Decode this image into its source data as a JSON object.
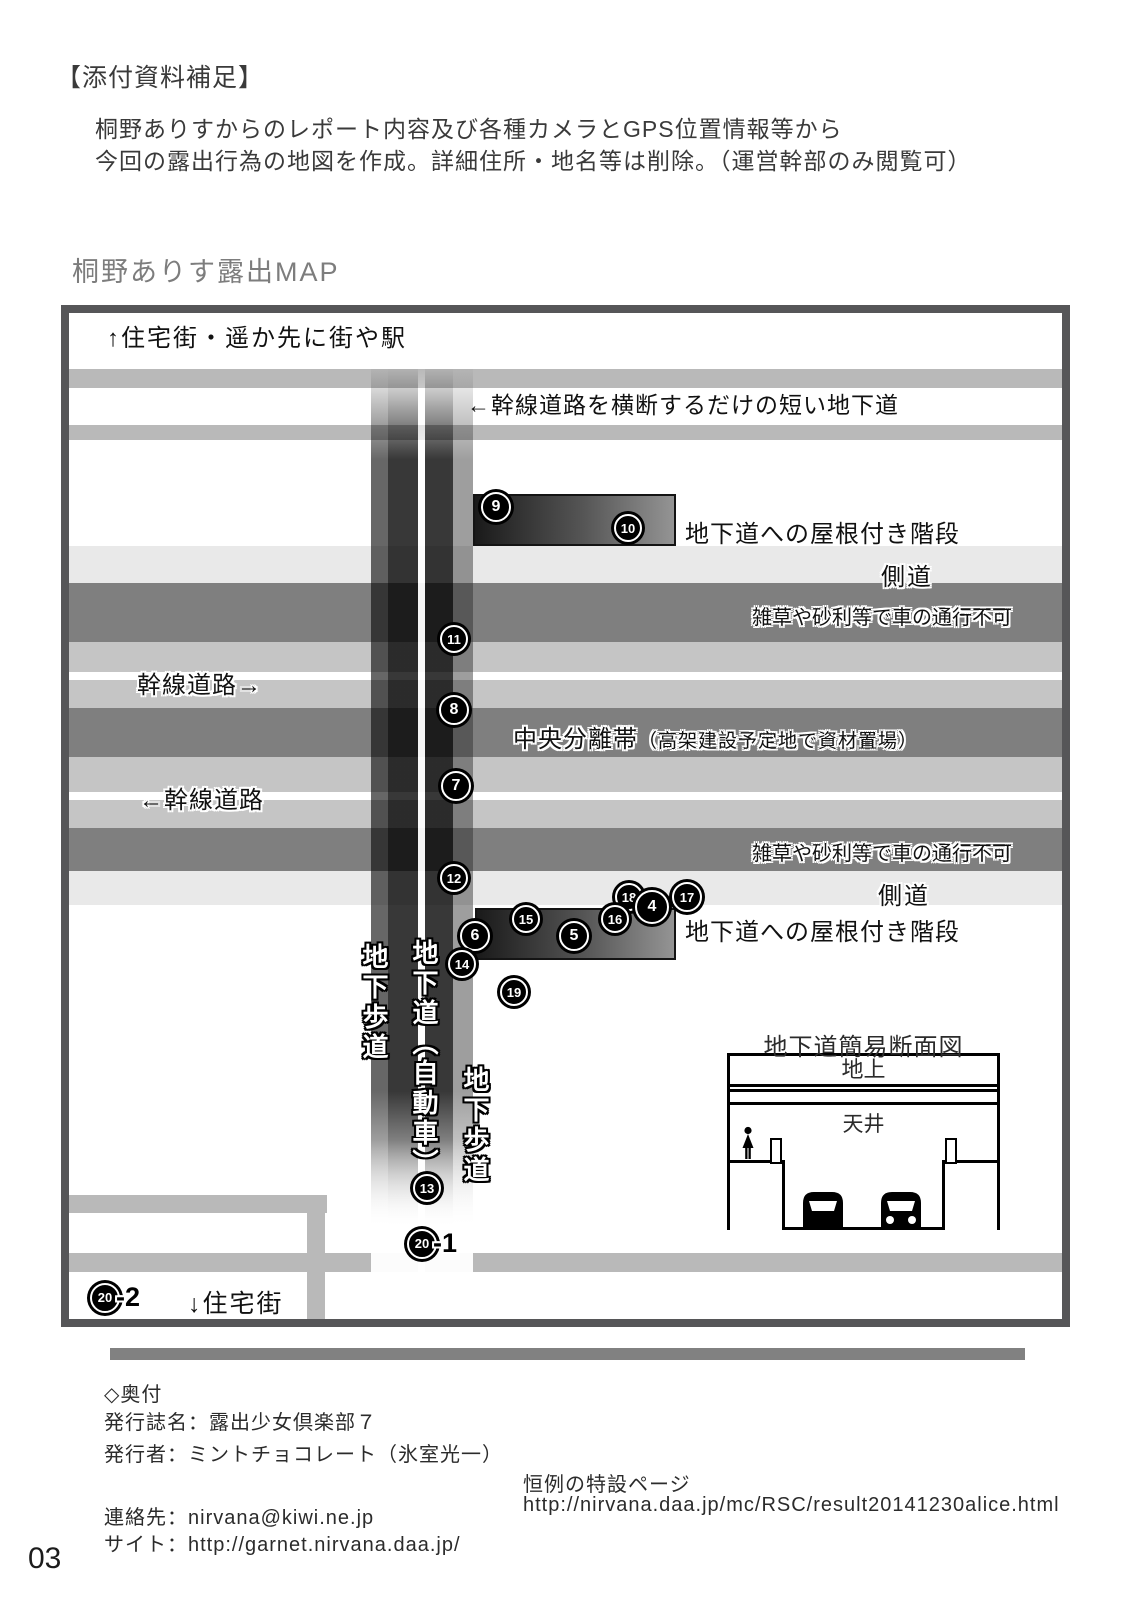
{
  "header": {
    "tag": "【添付資料補足】",
    "line1": "桐野ありすからのレポート内容及び各種カメラとGPS位置情報等から",
    "line2": "今回の露出行為の地図を作成。詳細住所・地名等は削除。（運営幹部のみ閲覧可）",
    "map_title": "桐野ありす露出MAP"
  },
  "map": {
    "labels": {
      "north": "↑住宅街・遥か先に街や駅",
      "short_underpass": "←幹線道路を横断するだけの短い地下道",
      "roofed_stairs_top": "地下道への屋根付き階段",
      "roofed_stairs_bottom": "地下道への屋根付き階段",
      "side_road_top": "側道",
      "side_road_bottom": "側道",
      "weeds_top": "雑草や砂利等で車の通行不可",
      "weeds_bottom": "雑草や砂利等で車の通行不可",
      "main_road_eastbound": "幹線道路→",
      "main_road_westbound": "←幹線道路",
      "median": "中央分離帯",
      "median_note": "（高架建設予定地で資材置場）",
      "ped_underpass_left": "地下歩道",
      "auto_underpass": "地下道（自動車）",
      "ped_underpass_right": "地下歩道",
      "south": "↓住宅街"
    },
    "pins": [
      {
        "label": "9",
        "x": 427,
        "y": 194,
        "size": 30
      },
      {
        "label": "10",
        "x": 559,
        "y": 215,
        "size": 28
      },
      {
        "label": "11",
        "x": 385,
        "y": 326,
        "size": 28
      },
      {
        "label": "8",
        "x": 385,
        "y": 397,
        "size": 30
      },
      {
        "label": "7",
        "x": 387,
        "y": 473,
        "size": 30
      },
      {
        "label": "12",
        "x": 385,
        "y": 565,
        "size": 28
      },
      {
        "label": "18",
        "x": 560,
        "y": 584,
        "size": 28
      },
      {
        "label": "4",
        "x": 583,
        "y": 594,
        "size": 34
      },
      {
        "label": "17",
        "x": 618,
        "y": 584,
        "size": 30
      },
      {
        "label": "15",
        "x": 457,
        "y": 606,
        "size": 28
      },
      {
        "label": "16",
        "x": 546,
        "y": 606,
        "size": 28
      },
      {
        "label": "6",
        "x": 406,
        "y": 623,
        "size": 30
      },
      {
        "label": "5",
        "x": 505,
        "y": 623,
        "size": 30
      },
      {
        "label": "14",
        "x": 393,
        "y": 651,
        "size": 28
      },
      {
        "label": "19",
        "x": 445,
        "y": 679,
        "size": 28
      },
      {
        "label": "13",
        "x": 358,
        "y": 875,
        "size": 28
      },
      {
        "label": "20",
        "suffix": "-1",
        "x": 353,
        "y": 930,
        "size": 30
      },
      {
        "label": "20",
        "suffix": "-2",
        "x": 36,
        "y": 984,
        "size": 30
      }
    ],
    "cross_section": {
      "title": "地下道簡易断面図",
      "ground": "地上",
      "ceiling": "天井"
    },
    "colors": {
      "road": "#b9b9b9",
      "side_road": "#e9e9e9",
      "dark_band": "#7f7f7f",
      "lane": "#c5c5c5",
      "frame": "#565658",
      "stair_dark": "#1a1a1a",
      "stair_light": "#949494",
      "bar": "#818181"
    }
  },
  "footer": {
    "colophon_heading": "◇奥付",
    "publication": "発行誌名：露出少女倶楽部７",
    "publisher": "発行者：ミントチョコレート（氷室光一）",
    "contact": "連絡先：nirvana@kiwi.ne.jp",
    "site": "サイト：http://garnet.nirvana.daa.jp/",
    "special_page_label": "恒例の特設ページ",
    "special_page_url": "http://nirvana.daa.jp/mc/RSC/result20141230alice.html",
    "page_number": "03"
  }
}
